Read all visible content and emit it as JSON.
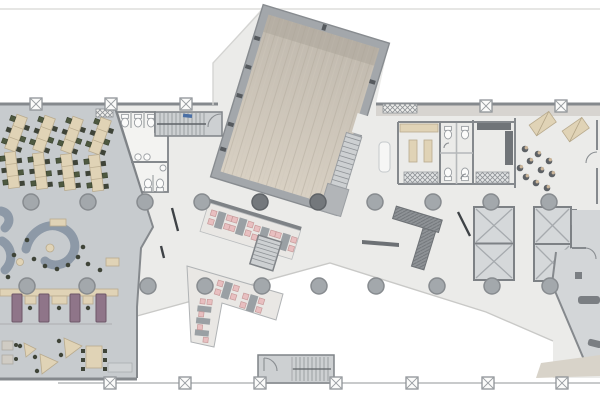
{
  "palette": {
    "paper": "#ffffff",
    "floor_cream": "#ebebe9",
    "floor_gray": "#c7cbce",
    "floor_gray_light": "#d3d6d8",
    "cafe_floor": "#e9e7e4",
    "wall": "#85898d",
    "wall_dark": "#5f6367",
    "hall_wall": "#a3a7ab",
    "wood_light": "#d8d0c3",
    "wood_dark": "#c0b9ae",
    "desk_tan": "#e0d3b6",
    "chair_olive": "#4e5940",
    "sofa_blue": "#8d99a7",
    "booth_plum": "#8f7589",
    "chair_pink": "#e8bfc0",
    "table_gray": "#9aa0a4",
    "stool_dark": "#5d6165",
    "stool_tan": "#cbb69b",
    "elevator_fill": "#d5d8da",
    "column_fill": "#a3a8ac",
    "accent_blue": "#4a6fa5",
    "strip_tan": "#d8d3c9",
    "bench_dark": "#7b7f83",
    "stair_fill": "#cdd0d2"
  },
  "zones": {
    "open_office_desks": "Open office desk rows",
    "restrooms_left": "Restrooms",
    "stair_top": "Staircase",
    "multipurpose_hall": "Multipurpose hall with wood floor",
    "hall_side_stair": "Hall side stair",
    "lounge_sofas": "Lounge with curved sofas",
    "focus_booths": "Focus booths",
    "meeting_tables": "Work tables",
    "cafe_band_upper": "Cafe seating terrace",
    "cafe_band_lower": "Cafe seating terrace",
    "cafe_stair": "Terrace stair",
    "plaza": "Central open plaza",
    "atrium_void": "Open void",
    "pantry": "Pantry",
    "wc_cells": "WC cells",
    "coffee_point": "Coffee point",
    "stool_lounge": "Stool lounge",
    "elevator_core_a": "Elevator core",
    "elevator_core_b": "Elevator core",
    "service_area": "Service area",
    "stair_bottom": "Fire stair",
    "structural_grid": "Structural columns"
  }
}
